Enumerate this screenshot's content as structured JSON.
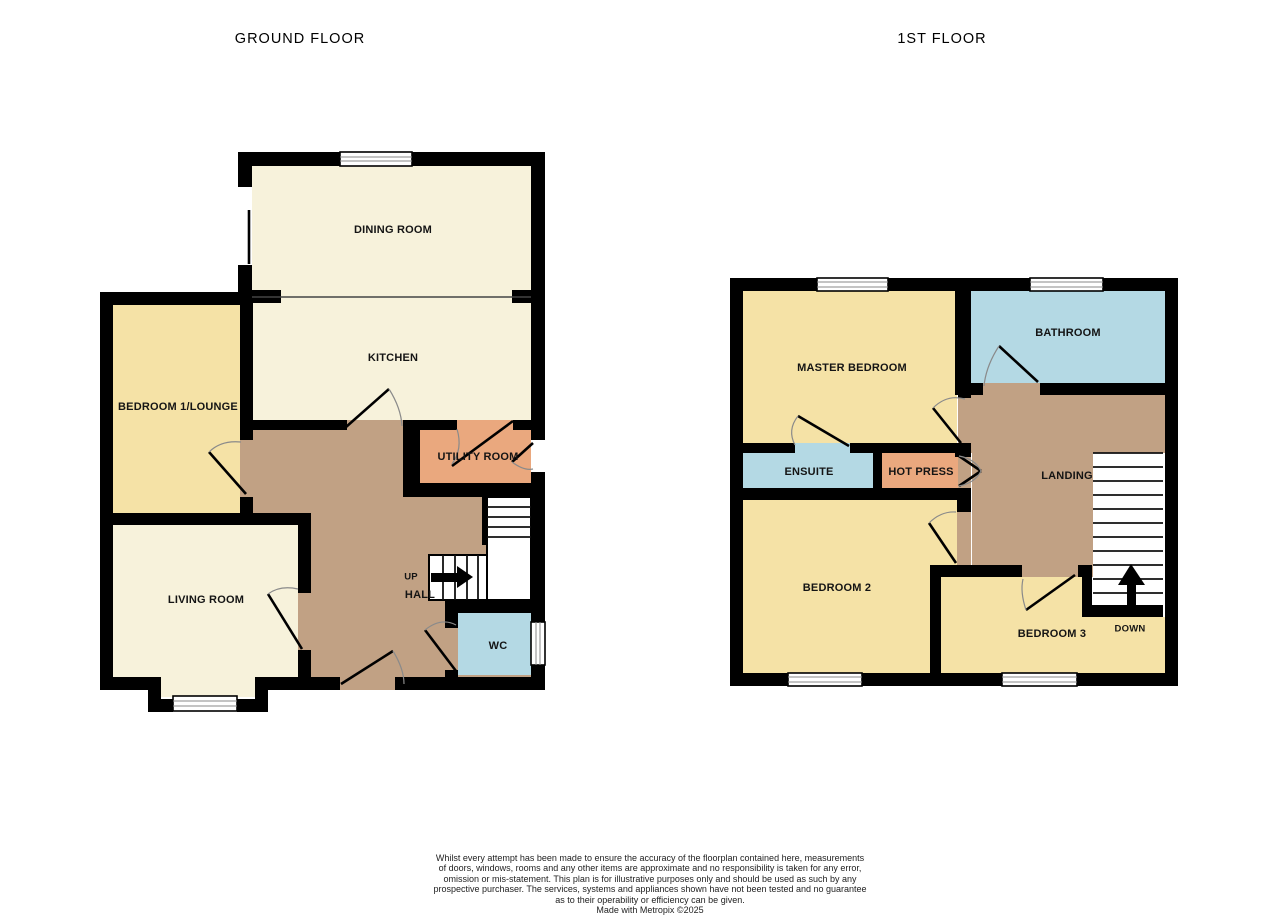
{
  "ground_floor": {
    "title": "GROUND FLOOR",
    "rooms": {
      "dining": "DINING ROOM",
      "kitchen": "KITCHEN",
      "bedroom1": "BEDROOM 1/LOUNGE",
      "utility": "UTILITY ROOM",
      "living": "LIVING ROOM",
      "hall": "HALL",
      "wc": "WC"
    },
    "stair_up": "UP"
  },
  "first_floor": {
    "title": "1ST FLOOR",
    "rooms": {
      "master": "MASTER BEDROOM",
      "bathroom": "BATHROOM",
      "ensuite": "ENSUITE",
      "hotpress": "HOT PRESS",
      "landing": "LANDING",
      "bedroom2": "BEDROOM 2",
      "bedroom3": "BEDROOM 3"
    },
    "stair_down": "DOWN"
  },
  "disclaimer": {
    "lines": [
      "Whilst every attempt has been made to ensure the accuracy of the floorplan contained here, measurements",
      "of doors, windows, rooms and any other items are approximate and no responsibility is taken for any error,",
      "omission or mis-statement. This plan is for illustrative purposes only and should be used as such by any",
      "prospective purchaser. The services, systems and appliances shown have not been tested and no guarantee",
      "as to their operability or efficiency can be given."
    ],
    "credit": "Made with Metropix ©2025"
  },
  "colors": {
    "wall": "#000000",
    "cream": "#F7F2DB",
    "yellow": "#F5E2A6",
    "brown": "#C1A184",
    "orange": "#EAA87E",
    "blue": "#B4D9E4",
    "arc": "#8A8A8A",
    "title": "#6A6A6A",
    "ink": "#141414"
  }
}
